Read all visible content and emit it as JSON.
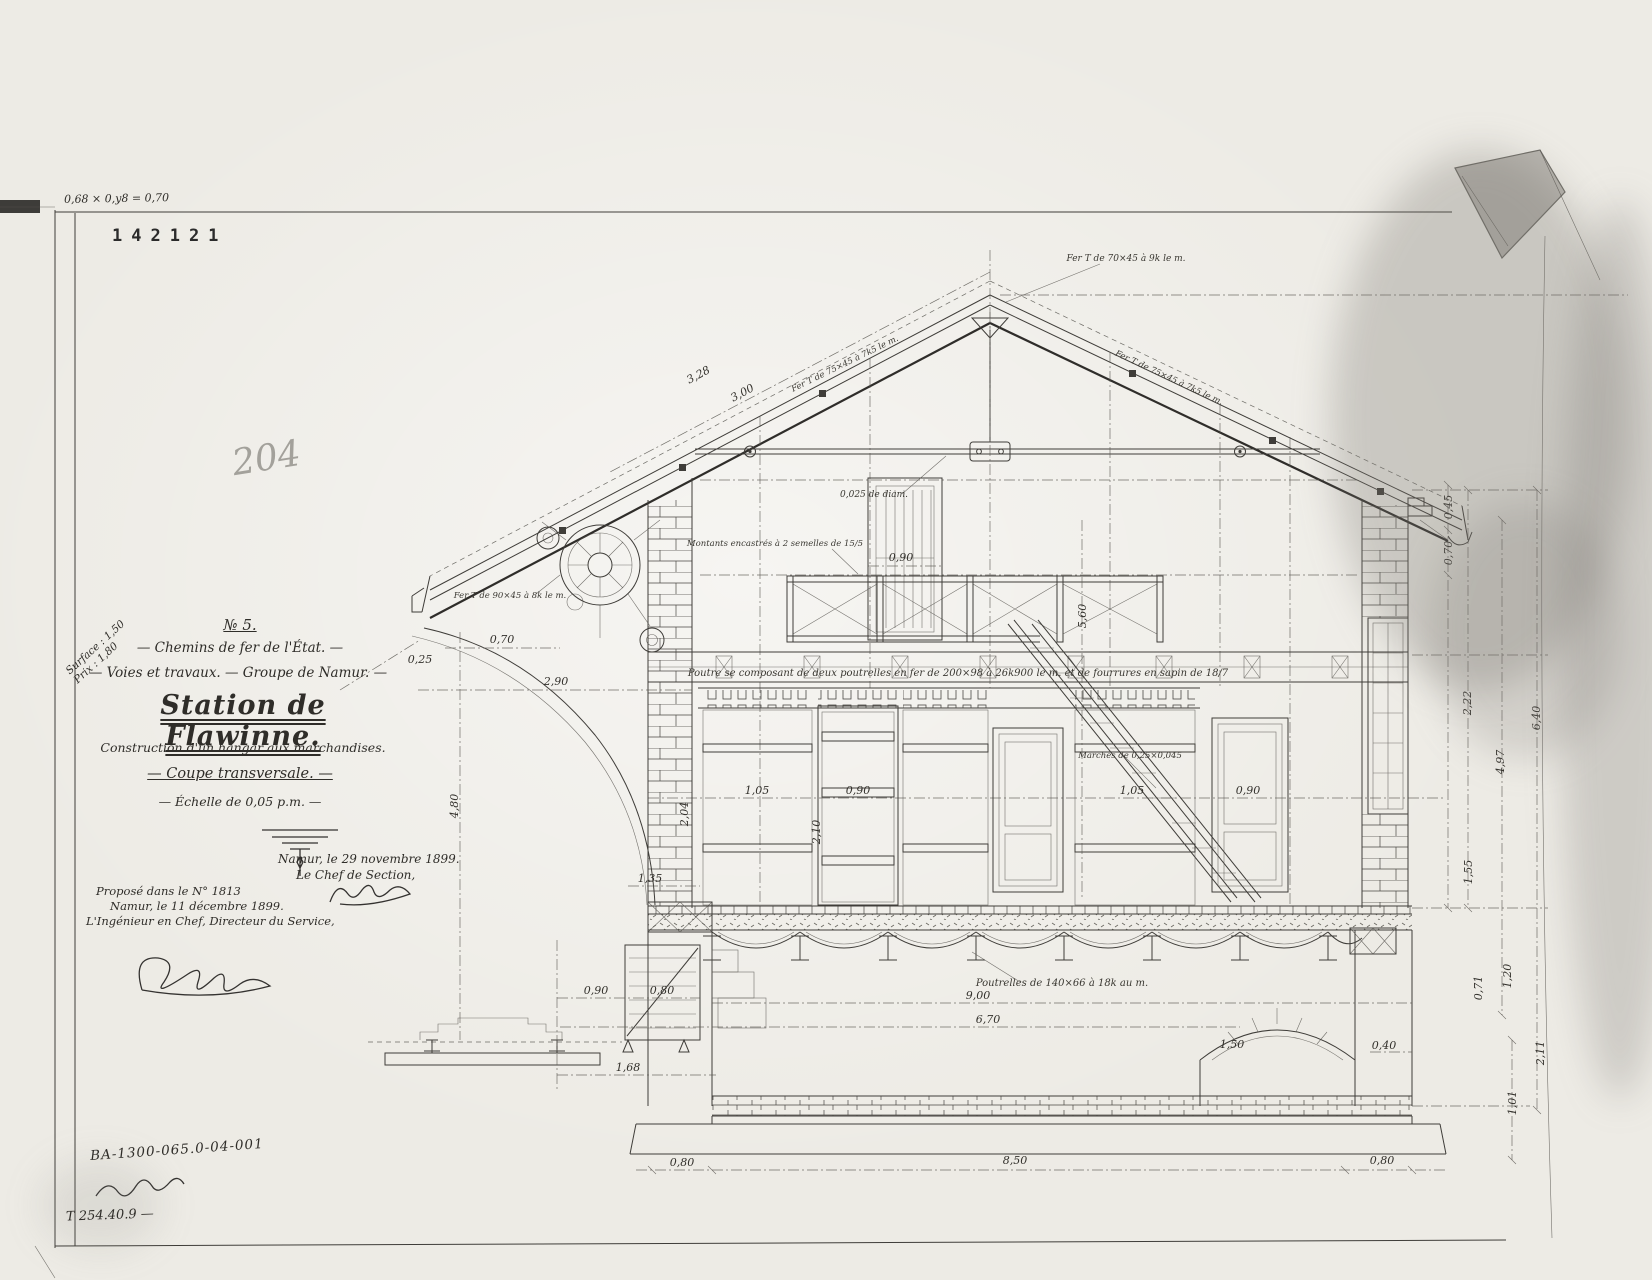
{
  "scan": {
    "corner_formula": "0,68 × 0,y8 = 0,70",
    "inventory_number": "142121",
    "pencil_number": "204",
    "bottom_reference": "BA-1300-065.0-04-001",
    "bottom_code": "T 254.40.9 —"
  },
  "title_block": {
    "drawing_number": "№ 5.",
    "administration": "— Chemins de fer de l'État. —",
    "department": "— Voies et travaux. — Groupe de Namur. —",
    "title": "Station de Flawinne.",
    "subtitle": "Construction d'un hangar aux marchandises.",
    "view": "— Coupe transversale. —",
    "scale": "— Échelle de 0,05 p.m. —",
    "margin_note": "Surface : 1,50\nPrix : 1,80",
    "approval_right_line1": "Namur, le 29 novembre 1899.",
    "approval_right_line2": "Le Chef de Section,",
    "approval_left_line1": "Proposé dans le N° 1813",
    "approval_left_line2": "Namur, le 11 décembre 1899.",
    "approval_left_line3": "L'Ingénieur en Chef, Directeur du Service,"
  },
  "drawing": {
    "dim_labels": [
      {
        "t": "0,80",
        "x": 682,
        "y": 1166
      },
      {
        "t": "8,50",
        "x": 1015,
        "y": 1164
      },
      {
        "t": "0,80",
        "x": 1382,
        "y": 1164
      },
      {
        "t": "9,00",
        "x": 978,
        "y": 999
      },
      {
        "t": "6,70",
        "x": 988,
        "y": 1023
      },
      {
        "t": "1,68",
        "x": 628,
        "y": 1071
      },
      {
        "t": "0,90",
        "x": 596,
        "y": 994
      },
      {
        "t": "0,80",
        "x": 662,
        "y": 994
      },
      {
        "t": "1,35",
        "x": 650,
        "y": 882
      },
      {
        "t": "1,50",
        "x": 1232,
        "y": 1048
      },
      {
        "t": "0,40",
        "x": 1384,
        "y": 1049
      },
      {
        "t": "0,45",
        "x": 1452,
        "y": 507,
        "r": -90
      },
      {
        "t": "0,70",
        "x": 1452,
        "y": 553,
        "r": -90
      },
      {
        "t": "2,22",
        "x": 1471,
        "y": 703,
        "r": -90
      },
      {
        "t": "1,55",
        "x": 1472,
        "y": 872,
        "r": -90
      },
      {
        "t": "0,71",
        "x": 1482,
        "y": 988,
        "r": -90
      },
      {
        "t": "1,20",
        "x": 1511,
        "y": 976,
        "r": -90
      },
      {
        "t": "4,97",
        "x": 1504,
        "y": 762,
        "r": -90
      },
      {
        "t": "6,40",
        "x": 1540,
        "y": 718,
        "r": -90
      },
      {
        "t": "1,01",
        "x": 1516,
        "y": 1103,
        "r": -90
      },
      {
        "t": "2,11",
        "x": 1544,
        "y": 1053,
        "r": -90
      },
      {
        "t": "3,28",
        "x": 700,
        "y": 378,
        "r": -28
      },
      {
        "t": "3,00",
        "x": 744,
        "y": 396,
        "r": -28
      },
      {
        "t": "2,90",
        "x": 556,
        "y": 685
      },
      {
        "t": "0,70",
        "x": 502,
        "y": 643
      },
      {
        "t": "0,25",
        "x": 420,
        "y": 663
      },
      {
        "t": "4,80",
        "x": 458,
        "y": 806,
        "r": -90
      },
      {
        "t": "0,90",
        "x": 901,
        "y": 561
      },
      {
        "t": "5,60",
        "x": 1086,
        "y": 616,
        "r": -90
      },
      {
        "t": "1,05",
        "x": 757,
        "y": 794
      },
      {
        "t": "0,90",
        "x": 858,
        "y": 794
      },
      {
        "t": "1,05",
        "x": 1132,
        "y": 794
      },
      {
        "t": "0,90",
        "x": 1248,
        "y": 794
      },
      {
        "t": "2,10",
        "x": 820,
        "y": 832,
        "r": -90
      },
      {
        "t": "2,04",
        "x": 688,
        "y": 814,
        "r": -90
      }
    ],
    "notes": [
      {
        "t": "Poutre se composant de deux poutrelles en fer de 200×98 à 26k900 le m. et de fourrures en sapin de 18/7",
        "x": 958,
        "y": 676,
        "fs": 10
      },
      {
        "t": "Poutrelles de 140×66 à 18k au m.",
        "x": 1062,
        "y": 986,
        "fs": 10
      },
      {
        "t": "0,025 de diam.",
        "x": 874,
        "y": 497,
        "fs": 9
      },
      {
        "t": "Fer T de 70×45 à 9k le m.",
        "x": 1126,
        "y": 261,
        "fs": 9
      },
      {
        "t": "Fer T de 75×45 à 7k5 le m.",
        "x": 846,
        "y": 366,
        "fs": 8.5,
        "r": -26
      },
      {
        "t": "Fer T de 75×45 à 7k5 le m.",
        "x": 1168,
        "y": 380,
        "fs": 8.5,
        "r": 25
      },
      {
        "t": "Montants encastrés à 2 semelles de 15/5",
        "x": 775,
        "y": 546,
        "fs": 8.5
      },
      {
        "t": "Marches de 0,25×0,045",
        "x": 1130,
        "y": 758,
        "fs": 8.5
      },
      {
        "t": "Fer T de 90×45 à 8k le m.",
        "x": 510,
        "y": 598,
        "fs": 8.5
      }
    ]
  }
}
